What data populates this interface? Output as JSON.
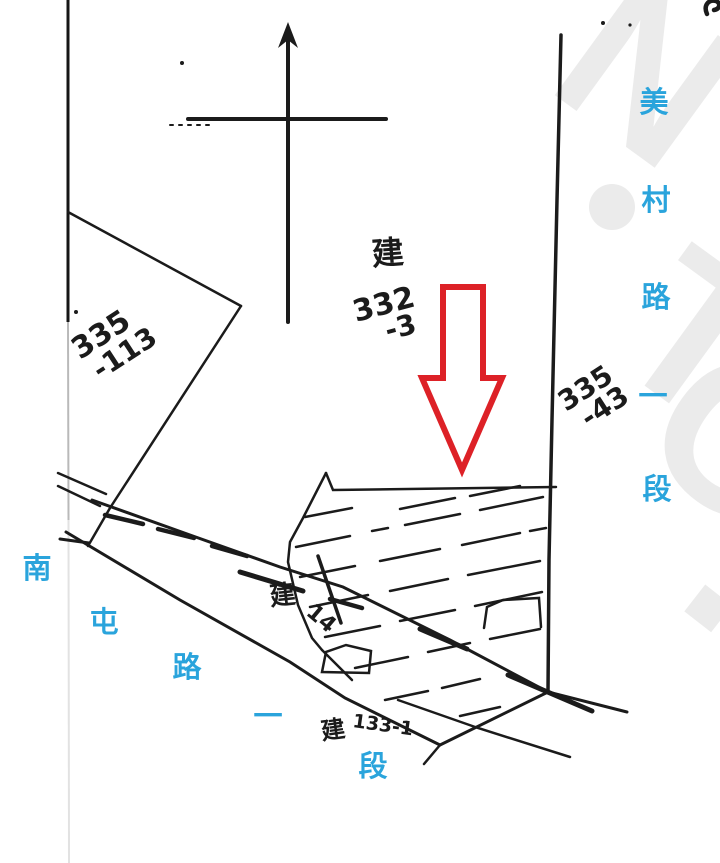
{
  "colors": {
    "ink": "#1b1b1b",
    "arrow_red": "#dd2127",
    "road_label_blue": "#2aa4dc",
    "watermark_gray": "#ebebeb"
  },
  "watermark": {
    "letters": [
      "N",
      ".",
      "T",
      "C"
    ]
  },
  "roads": {
    "meicun": {
      "name": "美村路一段",
      "chars": [
        "美",
        "村",
        "路",
        "一",
        "段"
      ]
    },
    "nantun": {
      "name": "南屯路一段",
      "chars": [
        "南",
        "屯",
        "路",
        "一",
        "段"
      ]
    }
  },
  "parcels": {
    "p335_113": {
      "num": "335",
      "sub": "-113"
    },
    "p332_3": {
      "marker": "建",
      "num": "332",
      "sub": "-3"
    },
    "p335_43": {
      "num": "335",
      "sub": "-43"
    },
    "p133_1": {
      "marker": "建",
      "num": "133-1"
    },
    "site_note": {
      "marker": "建",
      "sub": "14"
    }
  }
}
